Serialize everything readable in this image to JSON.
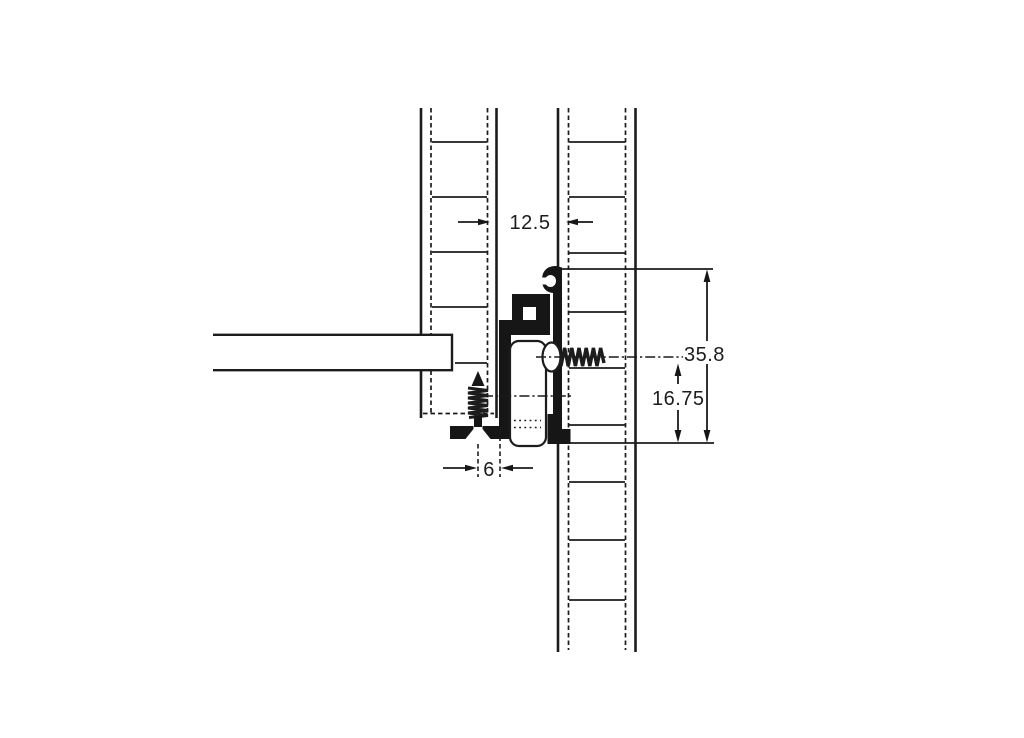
{
  "page": {
    "background": "#ffffff",
    "ink_color": "#1c1c1c"
  },
  "drawing": {
    "kind": "technical-section-drawing",
    "labels": {
      "gap_width": "12.5",
      "overall_height": "35.8",
      "centerline_height": "16.75",
      "screw_edge_distance": "6"
    }
  }
}
